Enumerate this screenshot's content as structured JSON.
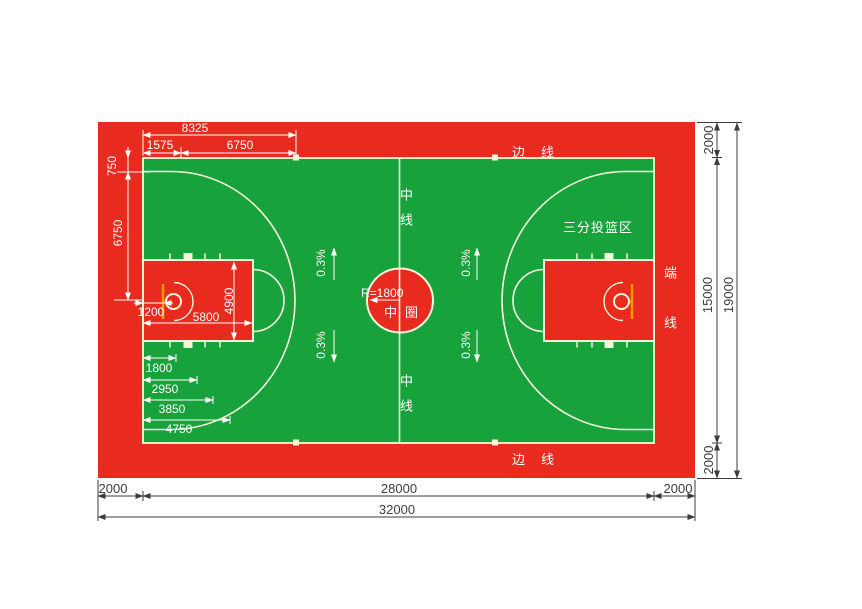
{
  "colors": {
    "buffer_red": "#e92a1e",
    "court_green": "#18a23c",
    "court_line": "#f6f6dc",
    "backboard_orange": "#f59b00",
    "dim_text_white": "#ffffff",
    "dim_text_dark": "#3c3c3c"
  },
  "labels": {
    "sideline": "边线",
    "endline": "端线",
    "center_line": "中线",
    "center_circle": "中圈",
    "three_point_zone": "三分投篮区"
  },
  "dims": {
    "top_total": "8325",
    "top_basket_offset": "1575",
    "top_arc_radius": "6750",
    "left_margin_3pt": "750",
    "left_half_width": "6750",
    "backboard_to_endline": "1200",
    "key_length": "5800",
    "key_width": "4900",
    "chain": [
      "1800",
      "2950",
      "3850",
      "4750"
    ],
    "center_radius": "R=1800",
    "slope": "0.3%",
    "bottom_margin_left": "2000",
    "court_length": "28000",
    "bottom_margin_right": "2000",
    "total_length": "32000",
    "right_margin_top": "2000",
    "court_width": "15000",
    "right_margin_bottom": "2000",
    "total_width": "19000"
  }
}
